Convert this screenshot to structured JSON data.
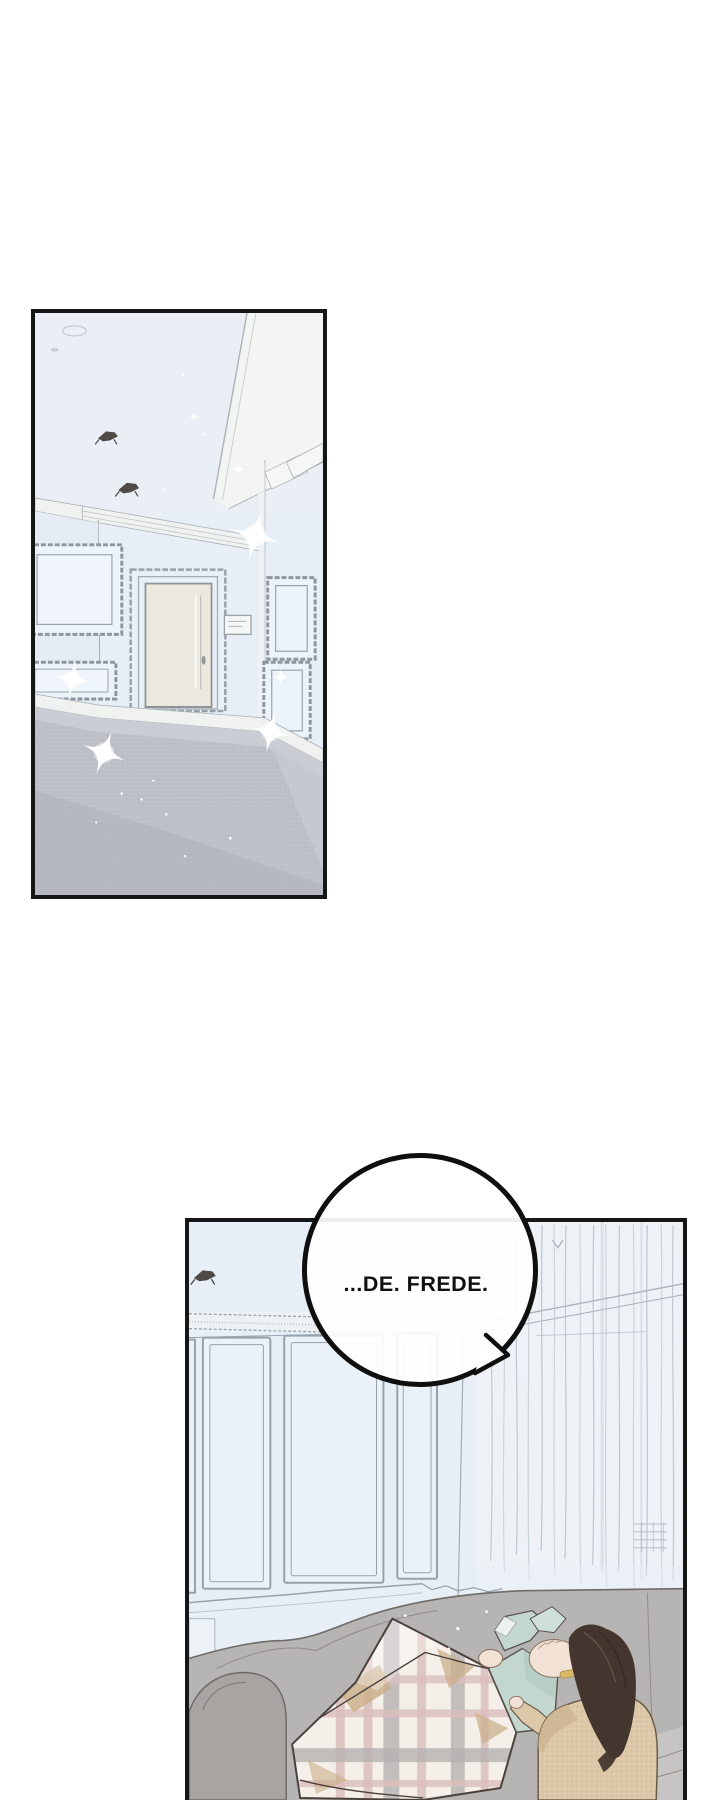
{
  "page": {
    "width": 720,
    "height": 1800,
    "background": "#ffffff"
  },
  "speech_bubble": {
    "text": "...DE. FREDE."
  },
  "panels": {
    "top": {
      "label": "pale blue empty room with door, wall frames, gray carpet and sparkles"
    },
    "bottom": {
      "label": "living room with sheer curtains; person lying on couch under plaid blanket, dark-haired person beside them"
    }
  },
  "colors": {
    "page_bg": "#ffffff",
    "ink": "#161616",
    "room_blue": "#e8eef6",
    "sketch": "#97a1aa",
    "molding": "#f0f2f1",
    "beam_white": "#f3f5f3",
    "door": "#ebe8e0",
    "carpet": "#bdc0c7",
    "carpet_light": "#cdd0d6",
    "carpet_dark": "#aeb1b9",
    "fixture_dark": "#4e4a48",
    "sparkle": "#ffffff",
    "couch": "#b7b5b3",
    "couch_dark": "#a7a4a2",
    "couch_seat": "#c7c5c3",
    "couch_line": "#6e6a68",
    "blanket": "#f5efe9",
    "plaid_pink": "#d9bebc",
    "plaid_gray": "#b5b1b0",
    "plaid_tan": "#c9ad87",
    "outline_dark": "#4a403c",
    "jacket_teal": "#c4d7cf",
    "jacket_teal_shade": "#aec8be",
    "skin": "#f2e1d5",
    "hair_dark": "#44362e",
    "cardigan": "#dcc8a8",
    "cardigan_shadow": "#cbb491",
    "jeans": "#a7bcd4",
    "bubble_fill": "#ffffff",
    "bubble_stroke": "#0f0f0f",
    "curtain_line": "#b3bdc7"
  }
}
